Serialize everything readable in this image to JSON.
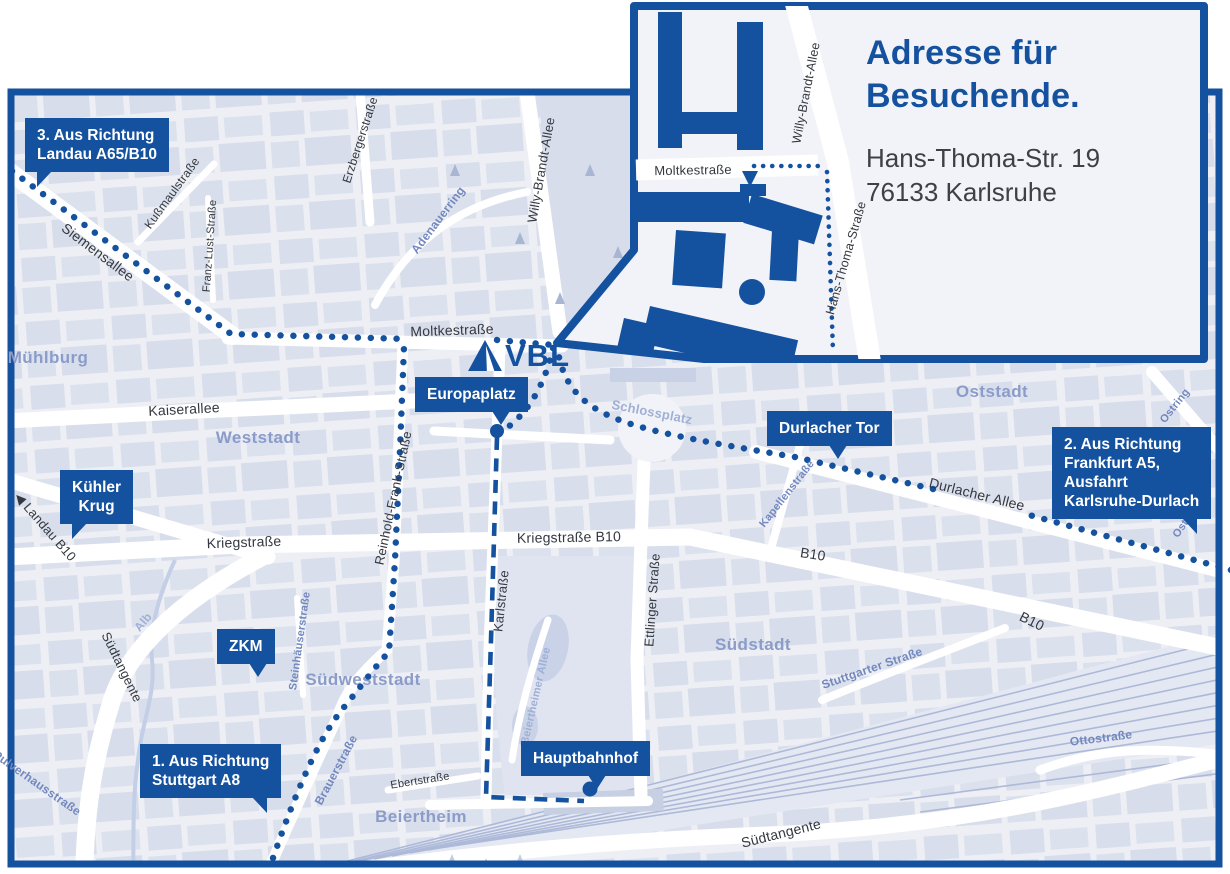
{
  "colors": {
    "accent": "#14519E",
    "map-bg": "#EDEFF5",
    "block": "#D9DEEC",
    "district": "#8B9CC9",
    "street-dark": "#34383F",
    "street-blue": "#7388BE",
    "street-light": "#9FB0D6",
    "route-dot": "#14519E",
    "inset-bg": "#F2F3F8"
  },
  "brand": {
    "logo_text": "VBL"
  },
  "inset": {
    "title": [
      "Adresse für",
      "Besuchende."
    ],
    "address": [
      "Hans-Thoma-Str. 19",
      "76133 Karlsruhe"
    ],
    "map_labels": [
      {
        "t": "Moltkestraße",
        "x": 693,
        "y": 170,
        "r": -1,
        "s": 13,
        "tone": "dark"
      },
      {
        "t": "Willy-Brandt-Allee",
        "x": 806,
        "y": 93,
        "r": -79,
        "s": 12.5,
        "tone": "dark"
      },
      {
        "t": "Hans-Thoma-Straße",
        "x": 846,
        "y": 258,
        "r": -74,
        "s": 12.5,
        "tone": "dark"
      }
    ]
  },
  "map": {
    "badges": [
      {
        "id": "landau",
        "lines": [
          "3. Aus Richtung",
          "Landau A65/B10"
        ],
        "x": 25,
        "y": 118,
        "tail": "bl"
      },
      {
        "id": "kuehler-krug",
        "lines": [
          "Kühler",
          "Krug"
        ],
        "x": 60,
        "y": 470,
        "tail": "bl",
        "center": true
      },
      {
        "id": "zkm",
        "lines": [
          "ZKM"
        ],
        "x": 217,
        "y": 629,
        "tail": "b",
        "center": true,
        "tx": "55%"
      },
      {
        "id": "stuttgart",
        "lines": [
          "1. Aus Richtung",
          "Stuttgart A8"
        ],
        "x": 140,
        "y": 744,
        "tail": "br"
      },
      {
        "id": "europaplatz",
        "lines": [
          "Europaplatz"
        ],
        "x": 415,
        "y": 377,
        "tail": "b",
        "tx": "68%"
      },
      {
        "id": "durlacher-tor",
        "lines": [
          "Durlacher Tor"
        ],
        "x": 767,
        "y": 411,
        "tail": "b",
        "tx": "50%"
      },
      {
        "id": "frankfurt",
        "lines": [
          "2. Aus Richtung",
          "Frankfurt A5,",
          "Ausfahrt",
          "Karlsruhe-Durlach"
        ],
        "x": 1052,
        "y": 427,
        "tail": "br"
      },
      {
        "id": "hauptbahnhof",
        "lines": [
          "Hauptbahnhof"
        ],
        "x": 521,
        "y": 741,
        "tail": "b",
        "tx": "52%"
      }
    ],
    "streets": [
      {
        "t": "Moltkestraße",
        "x": 452,
        "y": 330,
        "r": -2,
        "s": 14,
        "tone": "dark"
      },
      {
        "t": "Kaiserallee",
        "x": 184,
        "y": 409,
        "r": -3,
        "s": 14,
        "tone": "dark"
      },
      {
        "t": "Kriegstraße",
        "x": 244,
        "y": 542,
        "r": -2,
        "s": 14,
        "tone": "dark"
      },
      {
        "t": "Kriegstraße B10",
        "x": 569,
        "y": 537,
        "r": -1,
        "s": 14,
        "tone": "dark"
      },
      {
        "t": "Siemensallee",
        "x": 98,
        "y": 252,
        "r": 37,
        "s": 14,
        "tone": "dark"
      },
      {
        "t": "◀ Landau B10",
        "x": 45,
        "y": 527,
        "r": 49,
        "s": 13,
        "tone": "dark"
      },
      {
        "t": "Karlstraße",
        "x": 501,
        "y": 601,
        "r": -84,
        "s": 13,
        "tone": "dark"
      },
      {
        "t": "Ettlinger Straße",
        "x": 652,
        "y": 600,
        "r": -86,
        "s": 13,
        "tone": "dark"
      },
      {
        "t": "Reinhold-Frank-Straße",
        "x": 393,
        "y": 498,
        "r": -78,
        "s": 13,
        "tone": "dark"
      },
      {
        "t": "Willy-Brandt-Allee",
        "x": 541,
        "y": 170,
        "r": -80,
        "s": 13,
        "tone": "dark"
      },
      {
        "t": "Durlacher Allee",
        "x": 977,
        "y": 494,
        "r": 14,
        "s": 14,
        "tone": "dark"
      },
      {
        "t": "B10",
        "x": 813,
        "y": 554,
        "r": 9,
        "s": 14,
        "tone": "dark"
      },
      {
        "t": "B10",
        "x": 1032,
        "y": 621,
        "r": 26,
        "s": 14,
        "tone": "dark"
      },
      {
        "t": "Südtangente",
        "x": 122,
        "y": 667,
        "r": 64,
        "s": 13,
        "tone": "dark"
      },
      {
        "t": "Südtangente",
        "x": 781,
        "y": 833,
        "r": -14,
        "s": 14,
        "tone": "dark"
      },
      {
        "t": "Ebertstraße",
        "x": 420,
        "y": 781,
        "r": -9,
        "s": 11,
        "tone": "dark"
      },
      {
        "t": "Kußmaulstraße",
        "x": 172,
        "y": 193,
        "r": -54,
        "s": 12,
        "tone": "dark"
      },
      {
        "t": "Franz-Lust-Straße",
        "x": 210,
        "y": 246,
        "r": -86,
        "s": 11,
        "tone": "dark"
      },
      {
        "t": "Erzbergerstraße",
        "x": 360,
        "y": 140,
        "r": -72,
        "s": 12,
        "tone": "dark"
      },
      {
        "t": "Brauerstraße",
        "x": 336,
        "y": 770,
        "r": -62,
        "s": 12,
        "tone": "blue"
      },
      {
        "t": "Adenauerring",
        "x": 438,
        "y": 220,
        "r": -53,
        "s": 12,
        "tone": "blue"
      },
      {
        "t": "Kapellenstraße",
        "x": 787,
        "y": 494,
        "r": -52,
        "s": 11,
        "tone": "blue"
      },
      {
        "t": "Ostring",
        "x": 1175,
        "y": 406,
        "r": -52,
        "s": 11,
        "tone": "blue"
      },
      {
        "t": "Ostring",
        "x": 1187,
        "y": 520,
        "r": -55,
        "s": 11,
        "tone": "blue"
      },
      {
        "t": "Ottostraße",
        "x": 1101,
        "y": 738,
        "r": -7,
        "s": 12,
        "tone": "blue"
      },
      {
        "t": "Stuttgarter Straße",
        "x": 872,
        "y": 668,
        "r": -19,
        "s": 12,
        "tone": "blue"
      },
      {
        "t": "Pulverhausstraße",
        "x": 37,
        "y": 783,
        "r": 35,
        "s": 12,
        "tone": "blue"
      },
      {
        "t": "Steinhäuserstraße",
        "x": 300,
        "y": 641,
        "r": -82,
        "s": 11,
        "tone": "blue"
      },
      {
        "t": "Alb",
        "x": 143,
        "y": 622,
        "r": -50,
        "s": 12,
        "tone": "light"
      },
      {
        "t": "Beiertheimer Allee",
        "x": 536,
        "y": 696,
        "r": -77,
        "s": 11,
        "tone": "light"
      },
      {
        "t": "Schlossplatz",
        "x": 652,
        "y": 412,
        "r": 11,
        "s": 13,
        "tone": "light"
      }
    ],
    "districts": [
      {
        "t": "Mühlburg",
        "x": 48,
        "y": 358
      },
      {
        "t": "Weststadt",
        "x": 258,
        "y": 438
      },
      {
        "t": "Südweststadt",
        "x": 363,
        "y": 680
      },
      {
        "t": "Südstadt",
        "x": 753,
        "y": 645
      },
      {
        "t": "Oststadt",
        "x": 992,
        "y": 392
      },
      {
        "t": "Beiertheim",
        "x": 421,
        "y": 817
      }
    ]
  }
}
